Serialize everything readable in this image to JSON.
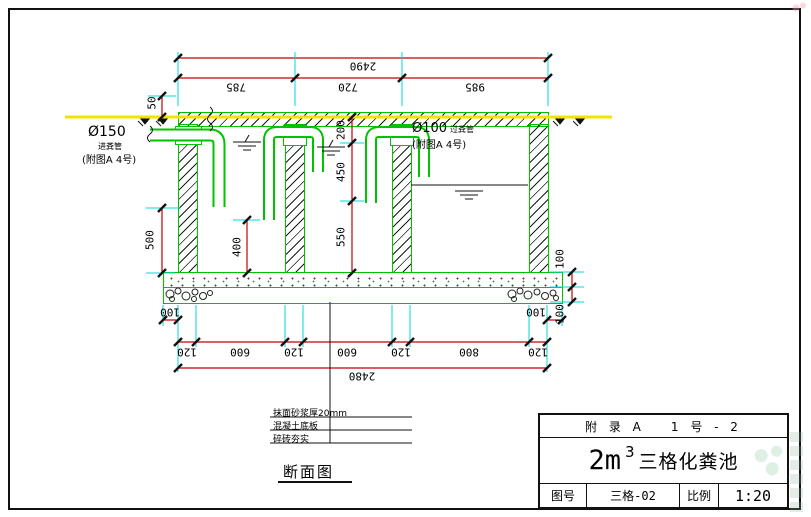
{
  "section_title": "断面图",
  "labels": {
    "inlet_dia": "Ø150",
    "inlet_name": "进粪管",
    "inlet_ref": "(附图A  4号)",
    "transfer_dia": "Ø100",
    "transfer_name": "过粪管",
    "transfer_ref": "(附图A  4号)"
  },
  "notes": [
    "抹面砂浆厚20mm",
    "混凝土底板",
    "碎砖夯实"
  ],
  "dimensions": {
    "top_total": "2490",
    "top_segments": [
      "785",
      "720",
      "985"
    ],
    "cover_height": "50",
    "inlet_drop": "500",
    "comp1_pipe_depth": "400",
    "mid_chain": [
      "200",
      "450",
      "550"
    ],
    "slab_thickness": "100",
    "cushion_thickness": "100",
    "footing_overhang_left": "100",
    "footing_overhang_right": "100",
    "bottom_segments": [
      "120",
      "600",
      "120",
      "600",
      "120",
      "800",
      "120"
    ],
    "bottom_total": "2480"
  },
  "title_block": {
    "appendix": "附 录 A",
    "sheet_no": "1 号 - 2",
    "volume": "2m",
    "volume_sup": "3",
    "title": "三格化粪池",
    "fig_label": "图号",
    "fig_value": "三格-02",
    "scale_label": "比例",
    "scale_value": "1:20"
  },
  "colors": {
    "structure_green": "#00c300",
    "dimension_red": "#c40000",
    "extension_cyan": "#00d9d9",
    "ground_yellow": "#f2e400"
  }
}
